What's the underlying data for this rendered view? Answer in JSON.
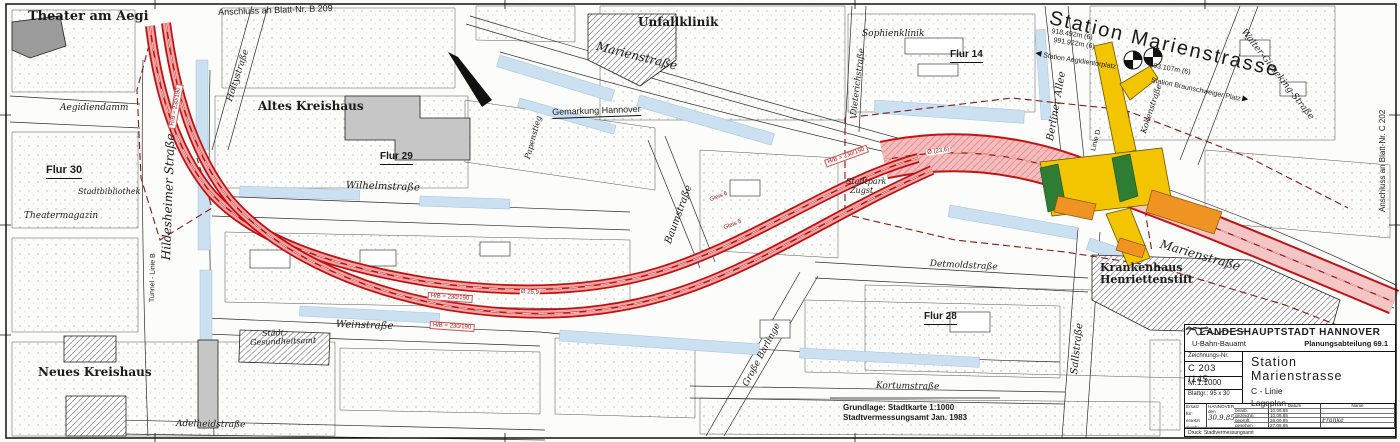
{
  "labels": {
    "theater_am_aegi": "Theater am Aegi",
    "anschluss_top": "Anschluss an Blatt-Nr. B 209",
    "anschluss_right": "Anschluss an Blatt-Nr. C 202",
    "unfallklinik": "Unfallklinik",
    "marienstrasse_nw": "Marienstraße",
    "marienstrasse_se": "Marienstraße",
    "station_marienstrasse": "Station Marienstrasse",
    "sophienklinik": "Sophienklinik",
    "flur_14": "Flur 14",
    "flur_28": "Flur 28",
    "flur_29": "Flur 29",
    "flur_30": "Flur 30",
    "dieterichstrasse": "Dieterichstraße",
    "berliner_allee": "Berliner Allee",
    "kokenstrasse": "Kokenstraße",
    "linie_d": "Linie D",
    "walter_gieseking_strasse": "Walter-Gieseking-Straße",
    "station_aegidientorplatz": "Station Aegidientorplatz",
    "station_braunschweiger_platz": "Station Braunschweiger Platz",
    "measure_918": "918.492m (6)",
    "measure_991": "991.922m (6)",
    "measure_603": "603.107m (6)",
    "altes_kreishaus": "Altes Kreishaus",
    "holtystrasse": "Holtystraße",
    "gemarkung_hannover": "Gemarkung Hannover",
    "aegidiendamm": "Aegidiendamm",
    "theatermagazin": "Theatermagazin",
    "stadtbibliothek": "Stadtbibliothek",
    "hildesheimer_strasse": "Hildesheimer Straße",
    "tunnel_linie_b": "Tunnel - Linie B",
    "wilhelmstrasse": "Wilhelmstraße",
    "papenstieg": "Papenstieg",
    "baumstrasse": "Baumstraße",
    "stadtpark_line1": "Stadtpark",
    "stadtpark_line2": "Zugst.",
    "weinstrasse": "Weinstraße",
    "gesundheitsamt_line1": "Städt.",
    "gesundheitsamt_line2": "Gesundheitsamt",
    "neues_kreishaus": "Neues Kreishaus",
    "adelheidstrasse": "Adelheidstraße",
    "grosse_barlinge": "Große Barlinge",
    "detmoldstrasse": "Detmoldstraße",
    "kortumstrasse": "Kortumstraße",
    "krankenhaus_line1": "Krankenhaus",
    "krankenhaus_line2": "Henriettenstift",
    "sallstrasse": "Sallstraße"
  },
  "route": {
    "hb_label_1": "H/B = 230/190",
    "hb_label_2": "H/B = 230/190",
    "hb_label_3": "H/B = 230/190",
    "dia_label_1": "Ø 25,9",
    "dia_label_2": "Ø (23,6)",
    "gleis_upper": "Gleis 6",
    "gleis_lower": "Gleis 5",
    "tunnel_pill": "H/B = 230/190"
  },
  "notes": {
    "grundlage_line1": "Grundlage: Stadtkarte 1:1000",
    "grundlage_line2": "Stadtvermessungsamt Jan. 1983"
  },
  "title_block": {
    "authority": "LANDESHAUPTSTADT  HANNOVER",
    "office": "U-Bahn-Bauamt",
    "department": "Planungsabteilung 69.1",
    "drawing_no_label": "Zeichnungs-Nr.",
    "drawing_no": "C 203 /145",
    "scale": "M.1:1000",
    "sheet": "Blattgr.: 95 x 30",
    "title": "Station  Marienstrasse",
    "line_name": "C - Linie",
    "plan_type": "Lageplan",
    "col_datum": "Datum",
    "col_name": "Name",
    "ersatz_fuer": "Ersatz für:",
    "ersetzt_durch": "ersetzt durch:",
    "gesehen_line": "gesehen:",
    "rows": [
      {
        "label": "bearb.",
        "date": "10.06.85",
        "name": ""
      },
      {
        "label": "gezeichn.",
        "date": "10.06.85",
        "name": ""
      },
      {
        "label": "geprüft",
        "date": "26.09.85",
        "name": "Franke"
      },
      {
        "label": "gesehen",
        "date": "27.09.85",
        "name": ""
      }
    ],
    "city": "HANNOVER, den",
    "hand_date": "30.9.85",
    "druck": "Druck: Stadtvermessungsamt"
  }
}
